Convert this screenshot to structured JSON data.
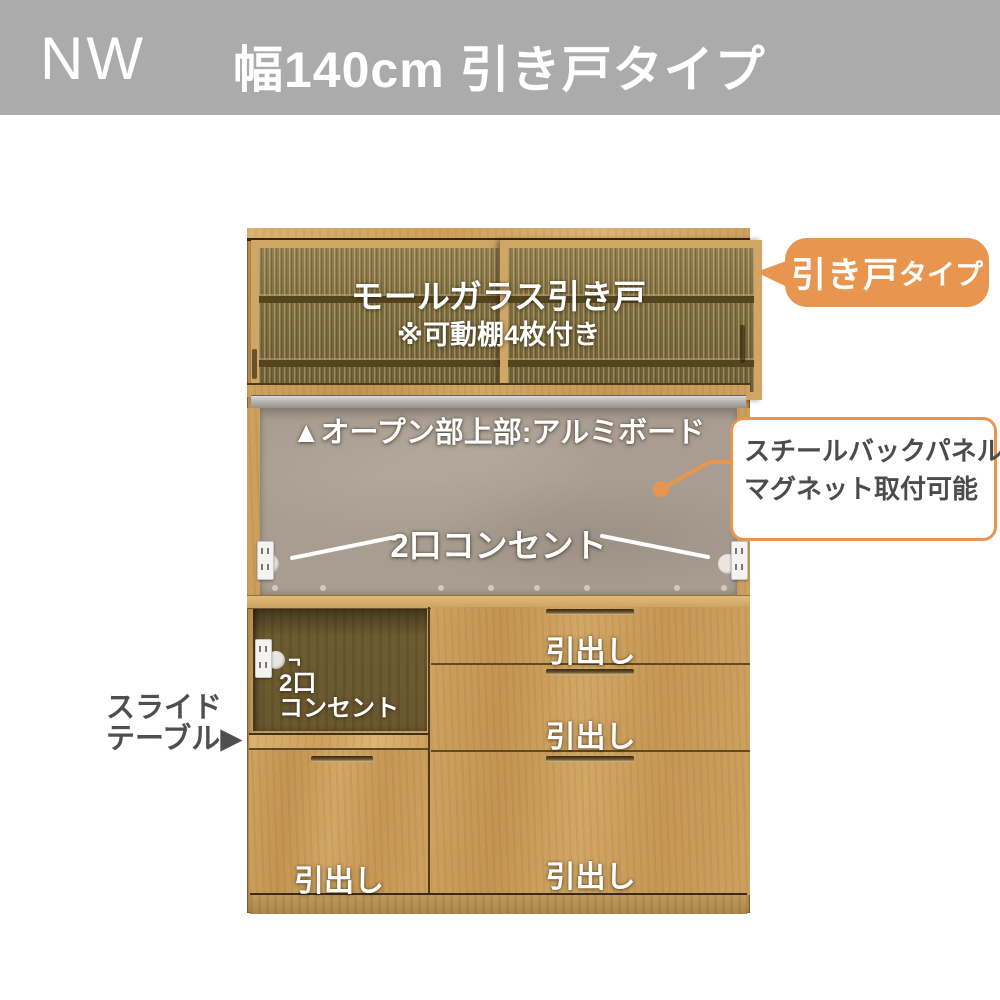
{
  "header": {
    "model": "NW",
    "title": "幅140cm 引き戸タイプ"
  },
  "hutch": {
    "glass_label": "モールガラス引き戸",
    "shelf_note": "※可動棚4枚付き"
  },
  "open_area": {
    "top_note": "▲オープン部上部:アルミボード",
    "outlet_label": "2口コンセント"
  },
  "slide_recess": {
    "pointer": "¬",
    "outlet_line1": "2口",
    "outlet_line2": "コンセント"
  },
  "drawers": {
    "labels": [
      "引出し",
      "引出し",
      "引出し",
      "引出し"
    ]
  },
  "callout_door_type": {
    "main": "引き戸",
    "sub": "タイプ"
  },
  "callout_back_panel": {
    "line1": "スチールバックパネル",
    "line2": "マグネット取付可能"
  },
  "callout_slide_table": {
    "line1": "スライド",
    "line2": "テーブル",
    "arrow": "▶"
  },
  "colors": {
    "accent_orange": "#E8964F",
    "header_gray": "#ABABAB",
    "wood": "#C89B5B",
    "back_panel_gray": "#A89D90",
    "label_text_dark": "#4F4F4F",
    "overlay_text": "#FFFFFF"
  }
}
